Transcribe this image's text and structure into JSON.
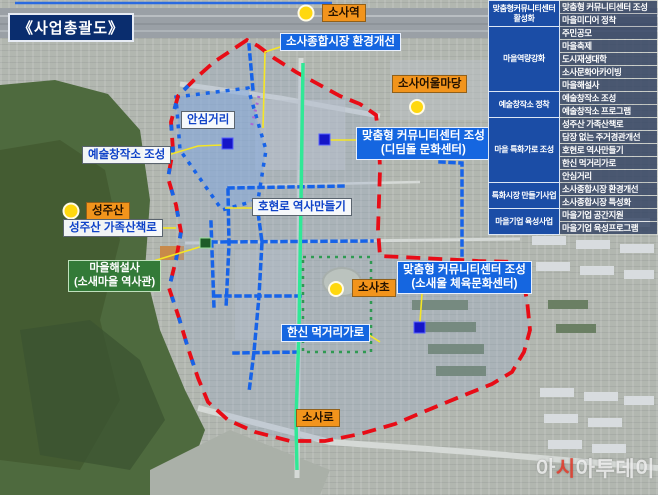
{
  "title": "《사업총괄도》",
  "map_labels": {
    "sosa_station": "소사역",
    "market_improvement": "소사종합시장 환경개선",
    "sosa_eoul_madang": "소사어울마당",
    "ansim_street": "안심거리",
    "art_studio_creation": "예술창작소 조성",
    "community_center_didimdol": [
      "맞춤형 커뮤니티센터 조성",
      "(디딤돌 문화센터)"
    ],
    "seongjusan": "성주산",
    "seongjusan_family_trail": "성주산 가족산책로",
    "hohyeonro_history": "호현로 역사만들기",
    "village_storyteller": [
      "마을해설사",
      "(소새마을 역사관)"
    ],
    "sosa_elementary": "소사초",
    "community_center_sosaeul": [
      "맞춤형 커뮤니티센터 조성",
      "(소새울 체육문화센터)"
    ],
    "hanshin_food_street": "한신 먹거리가로",
    "sosa_road": "소사로"
  },
  "legend_table": {
    "groups": [
      {
        "category": "맞춤형커뮤니티센터 활성화",
        "items": [
          "맞춤형 커뮤니티센터 조성",
          "마을미디어 정착"
        ]
      },
      {
        "category": "마을역량강화",
        "items": [
          "주민공모",
          "마을축제",
          "도시재생대학",
          "소사문화아카이빙",
          "마을해설사"
        ]
      },
      {
        "category": "예술창작소 정착",
        "items": [
          "예술창작소 조성",
          "예술창작소 프로그램"
        ]
      },
      {
        "category": "마을 특화가로 조성",
        "items": [
          "성주산 가족산책로",
          "담장 없는 주거경관개선",
          "호현로 역사만들기",
          "한신 먹거리가로",
          "안심거리"
        ]
      },
      {
        "category": "특화시장 만들기사업",
        "items": [
          "소사종합시장 환경개선",
          "소사종합시장 특성화"
        ]
      },
      {
        "category": "마을기업 육성사업",
        "items": [
          "마을기업 공간지원",
          "마을기업 육성프로그램"
        ]
      }
    ]
  },
  "watermark": {
    "part1": "아",
    "part2": "시",
    "part3": "아투데이"
  },
  "colors": {
    "boundary_red": "#e80c16",
    "road_dotted_blue": "#1763e8",
    "main_green_line": "#30e896",
    "green_dotted_zone": "#2f9a52",
    "purple_dotted": "#a96ad6",
    "connector_yellow": "#f5e625",
    "zone_fill_blue": "#7fa8e0",
    "label_blue_bg": "#1566e0",
    "label_orange_bg": "#f2941c",
    "label_green_bg": "#337a38",
    "title_navy_bg": "#0a2d6e",
    "table_category_bg": "#1b4da6",
    "marker_yellow": "#ffd80e",
    "marker_blue_square": "#1515c8",
    "marker_green_square": "#1e5c28",
    "watermark_red": "#e23e2e"
  }
}
